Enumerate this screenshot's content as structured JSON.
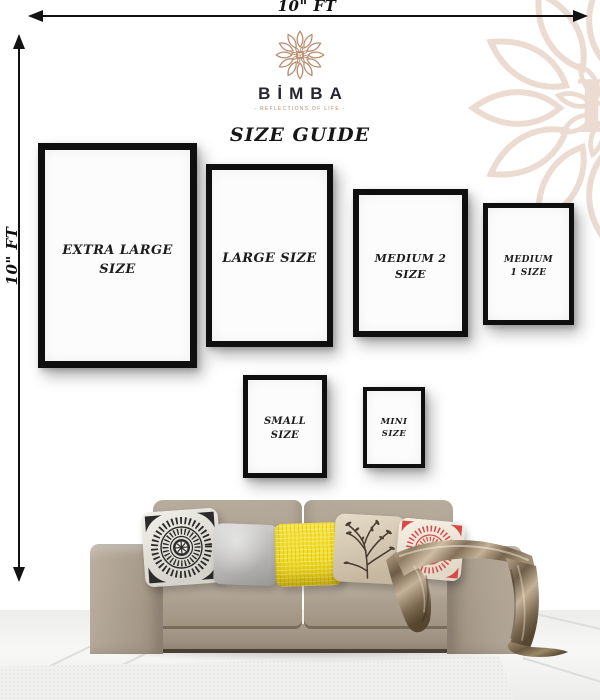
{
  "header": {
    "brand": "BİMBA",
    "tagline": "- REFLECTIONS OF LIFE -",
    "title": "SIZE GUIDE"
  },
  "dimensions": {
    "width_label": "10\" FT",
    "height_label": "10\" FT"
  },
  "frames": [
    {
      "name": "extra-large",
      "label": "EXTRA LARGE SIZE"
    },
    {
      "name": "large",
      "label": "LARGE SIZE"
    },
    {
      "name": "medium-2",
      "label": "MEDIUM 2 SIZE"
    },
    {
      "name": "medium-1",
      "label": "MEDIUM 1 SIZE"
    },
    {
      "name": "small",
      "label": "SMALL SIZE"
    },
    {
      "name": "mini",
      "label": "MINI SIZE"
    }
  ],
  "scene": {
    "sofa": "taupe-three-seater-sofa",
    "pillows": [
      "black-white-mandala",
      "plain-gray",
      "yellow-knit",
      "botanical-print",
      "red-mandala"
    ],
    "blanket": "satin-taupe-throw",
    "floor": "white-tile-floor"
  },
  "colors": {
    "logo_accent": "#b98d6f",
    "watermark": "#e9d8cb",
    "frame_border": "#0f0f0f",
    "text_dark": "#1c1c1c",
    "sofa_main": "#aca091",
    "pillow_yellow": "#f2de26",
    "pillow_red": "#d64949",
    "blanket_mid": "#9b8a72"
  }
}
